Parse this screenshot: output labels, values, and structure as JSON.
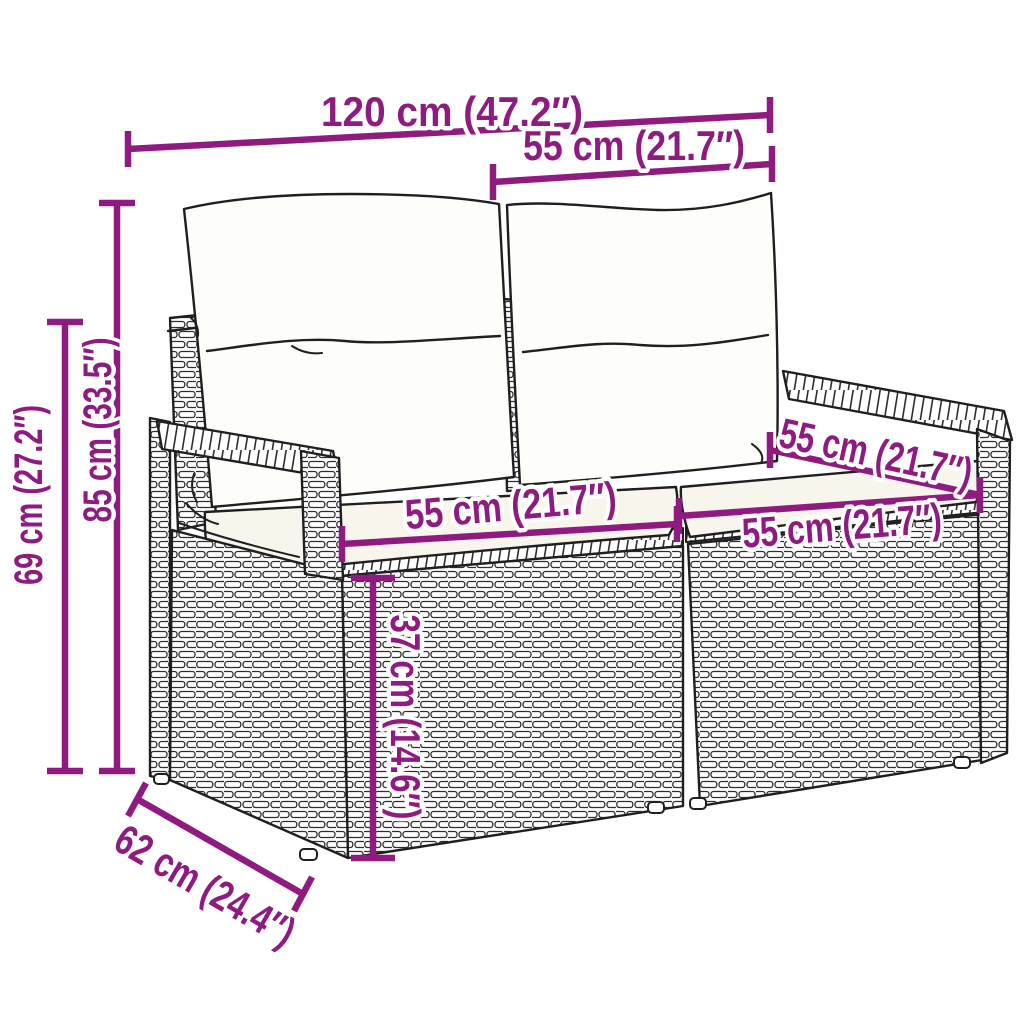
{
  "diagram": {
    "description": "Line drawing of a two-seater poly rattan garden sofa with back cushions and seat cushions, annotated with product dimensions",
    "colors": {
      "background": "#ffffff",
      "dimension": "#8f1b80",
      "line_art": "#1f1f1f"
    },
    "dimensions": {
      "overall_width": {
        "label": "120 cm (47.2″)"
      },
      "back_section_width": {
        "label": "55 cm (21.7″)"
      },
      "total_height": {
        "label": "85 cm (33.5″)"
      },
      "armrest_height": {
        "label": "69 cm (27.2″)"
      },
      "seat_width_left": {
        "label": "55 cm (21.7″)"
      },
      "seat_width_right": {
        "label": "55 cm (21.7″)"
      },
      "seat_depth": {
        "label": "55 cm (21.7″)"
      },
      "seat_height": {
        "label": "37 cm (14.6″)"
      },
      "overall_depth": {
        "label": "62 cm (24.4″)"
      }
    }
  }
}
